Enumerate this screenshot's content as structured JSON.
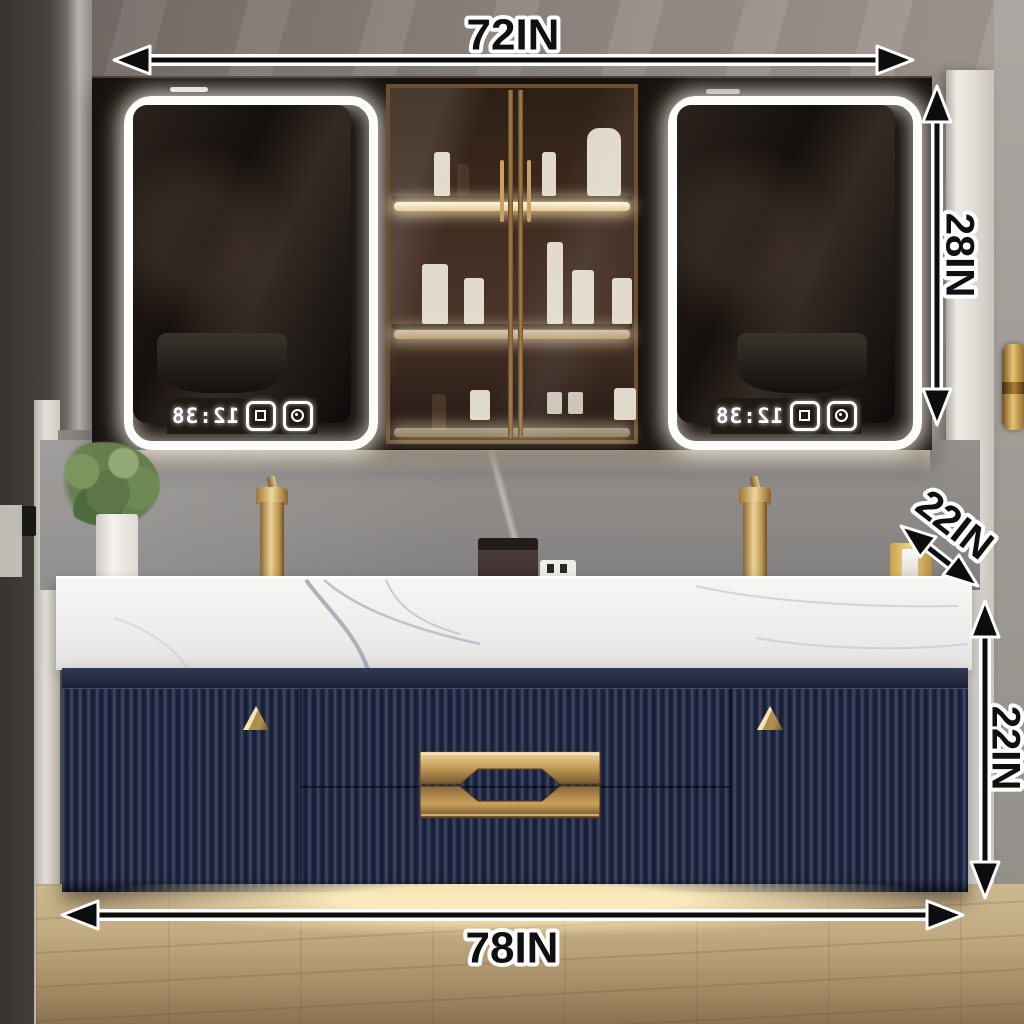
{
  "dimensions": {
    "cabinet_width": "72IN",
    "mirror_cabinet_height": "28IN",
    "countertop_depth": "22IN",
    "vanity_height": "22IN",
    "vanity_width": "78IN"
  },
  "mirrors": {
    "left": {
      "clock": "12:38"
    },
    "right": {
      "clock": "12:38"
    }
  },
  "colors": {
    "annotation_ink": "#101010",
    "annotation_halo": "#ffffff",
    "vanity_navy": "#20273e",
    "brushed_gold": "#c9a25c",
    "led_glow": "#fff6e0",
    "marble_top": "#f4f3f1",
    "backsplash_grey": "#8b8886",
    "floor_wood": "#c2ab82"
  }
}
